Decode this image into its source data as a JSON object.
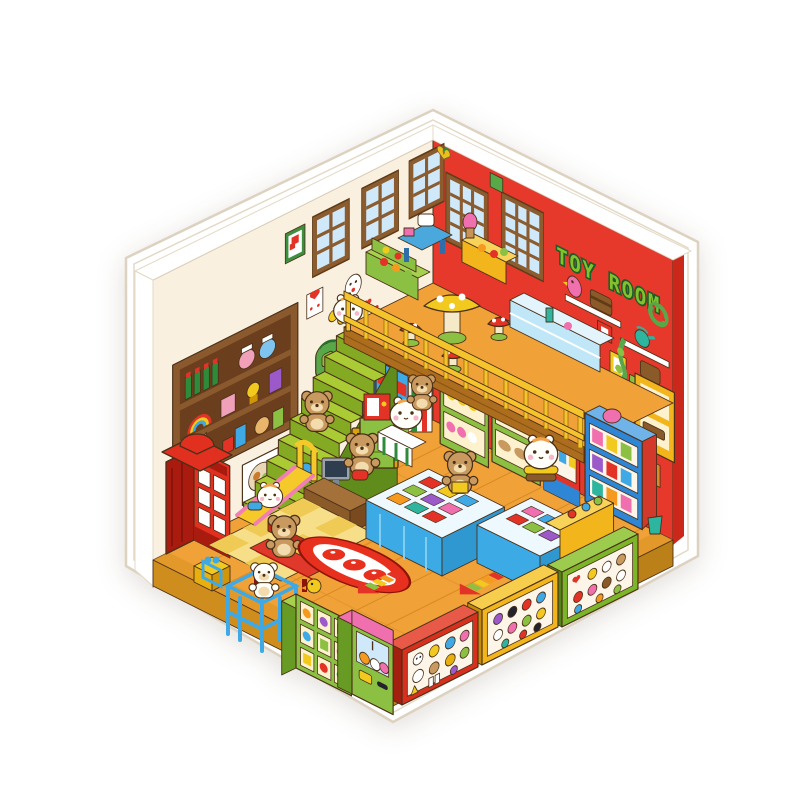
{
  "image": {
    "kind": "die-cut sticker illustration",
    "subject": "isometric kawaii pixel-art toy room interior",
    "background": "plain white"
  },
  "sign": {
    "text": "TOY ROOM"
  },
  "palette": {
    "bg": "#ffffff",
    "sticker": "#ffffff",
    "stickerEdge": "#e4d9c6",
    "wallCream": "#faf0df",
    "wallRed": "#e6392b",
    "wallRedSide": "#c9281a",
    "signGreen": "#84c22d",
    "signDark": "#1e5c28",
    "winFrame": "#8a5c30",
    "winFrameDark": "#5f3c17",
    "winPane": "#cfe9fa",
    "floor": "#f0a238",
    "floorLine": "#d3821c",
    "floorBand": "#dd9426",
    "platRight": "#bc8018",
    "platLeft": "#cf8d1d",
    "stairTop": "#aacb33",
    "stairFront": "#84a922",
    "stairSide": "#5f8c1a",
    "loftFascia": "#ad6d1e",
    "rail": "#f5c32b",
    "railDark": "#9c7209",
    "booth": "#e1301f",
    "boothDark": "#a81b0e",
    "shelfBrown": "#8a5a2e",
    "shelfBrownDark": "#6b3f1d",
    "green": "#8cc043",
    "greenDark": "#679b23",
    "greenLight": "#a6d14e",
    "cabYellow": "#f2b51c",
    "cabYellowDark": "#d09608",
    "tableBlue": "#3caae4",
    "tableBlueDark": "#2f98d0",
    "cloth": "#bfe7f8",
    "caseRed": "#d8301f",
    "caseGreen": "#7cb52a",
    "caseYellow": "#f2b51c",
    "glass": "#fdf6e8",
    "rugRed": "#e8301f",
    "matYellow": "#f7df8a",
    "matYellow2": "#efca55",
    "climbBlue": "#3fa9e6",
    "slideYellow": "#f6c92b",
    "slidePink": "#f27fb4",
    "clawPink": "#f06fae",
    "magBlue": "#2f86d4",
    "vendRed": "#e33226",
    "bear": "#c99a5f",
    "bearDark": "#8a5a28",
    "creamFur": "#f2dcae",
    "ham": "#fffef8",
    "blush": "#f6b7c9",
    "ol": "#4a3018",
    "stoolRed": "#e33226",
    "mushYellow": "#f2c91f"
  },
  "scene": {
    "walls": [
      "cream left wall with three windows",
      "red right wall with two windows and TOY ROOM sign"
    ],
    "objects": [
      "red phone booth",
      "gift box",
      "green staircase",
      "wall TV",
      "computer desk",
      "yellow slide",
      "red bench",
      "blue climbing frame",
      "checkered play mat",
      "toy cube shelf",
      "claw machine",
      "red badge display case",
      "yellow badge display case",
      "green badge display case",
      "blue merchandise tables",
      "cat-face rug",
      "loft with yellow railing",
      "mushroom table",
      "mushroom stools",
      "market shelves",
      "craft table",
      "glass counter",
      "flower plush shelf",
      "plush shoe shelf",
      "toy vending machine",
      "magazine rack",
      "wall shelf with toys",
      "framed pictures",
      "yellow wall cabinets",
      "white wall shelves",
      "hanging plant",
      "floor arrow decals"
    ],
    "characters": [
      "hamster at stair top",
      "teddy bear on stairs",
      "hamster on slide",
      "teddy bear on bench",
      "white bear on climbing frame",
      "shopkeeper hamster",
      "teddy bear with phone",
      "teddy bear with book",
      "teddy bear with bag",
      "burger hamster",
      "teddy bear lying on shelf",
      "yellow duckling"
    ]
  }
}
